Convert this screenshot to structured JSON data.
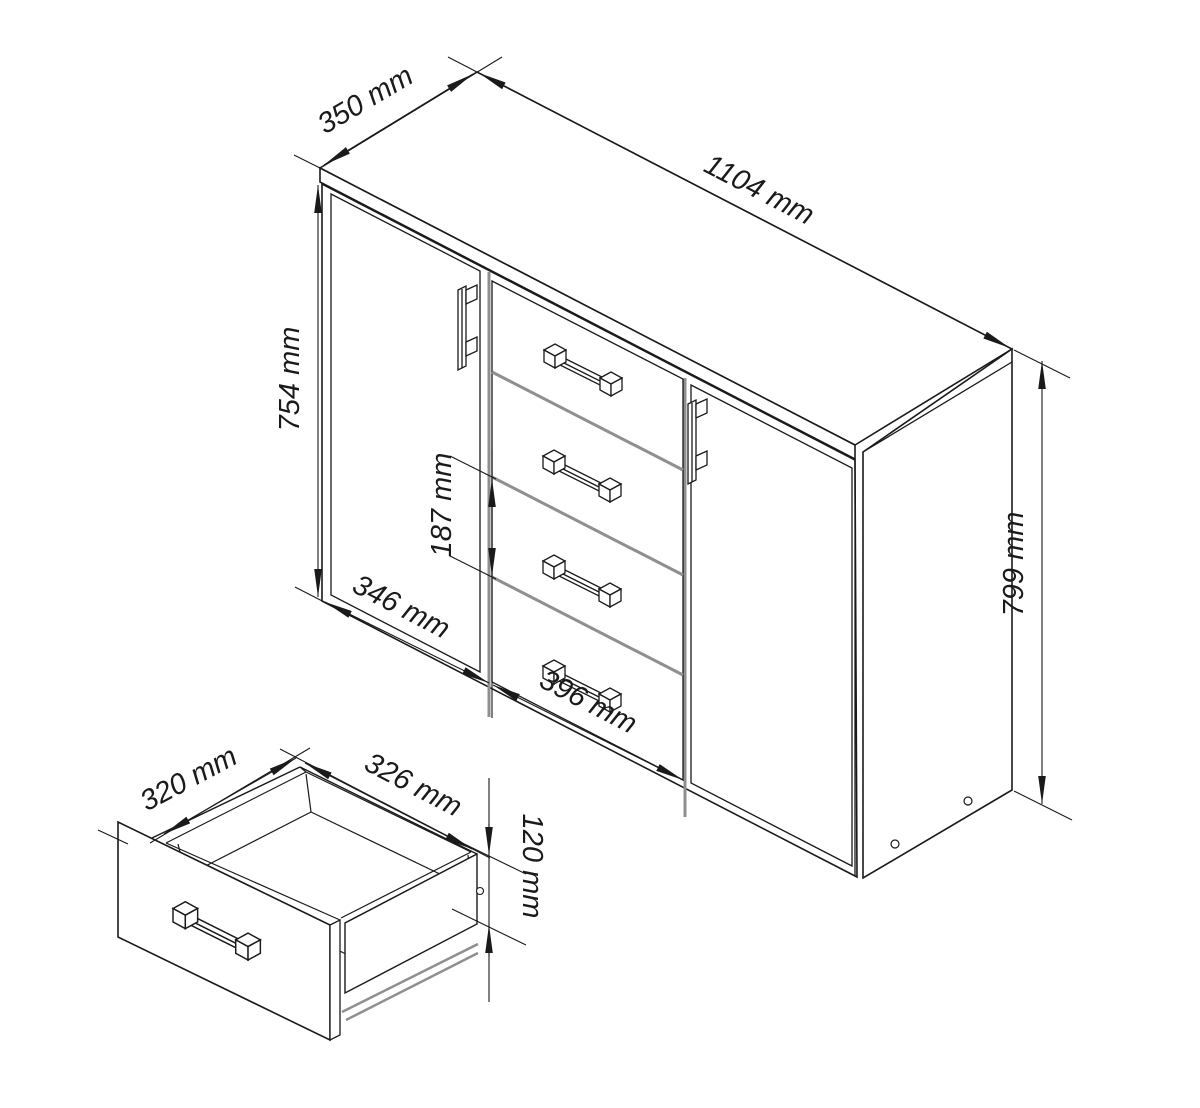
{
  "figure": {
    "kind": "furniture technical dimension drawing",
    "main_view": "sideboard with left door, four center drawers and right door",
    "detail_view": "open drawer box detail"
  },
  "colors": {
    "background": "#ffffff",
    "line": "#1a1a1a",
    "divider": "#8f8f8f",
    "text": "#1a1a1a"
  },
  "dimensions": {
    "top_depth": {
      "label": "350 mm"
    },
    "overall_width": {
      "label": "1104 mm"
    },
    "door_height": {
      "label": "754 mm"
    },
    "drawer_front_pitch": {
      "label": "187 mm"
    },
    "door_width": {
      "label": "346 mm"
    },
    "drawer_width": {
      "label": "396 mm"
    },
    "side_height": {
      "label": "799 mm"
    },
    "drawer_inner_depth": {
      "label": "320 mm"
    },
    "drawer_inner_width": {
      "label": "326 mm"
    },
    "drawer_box_height": {
      "label": "120 mm"
    }
  }
}
